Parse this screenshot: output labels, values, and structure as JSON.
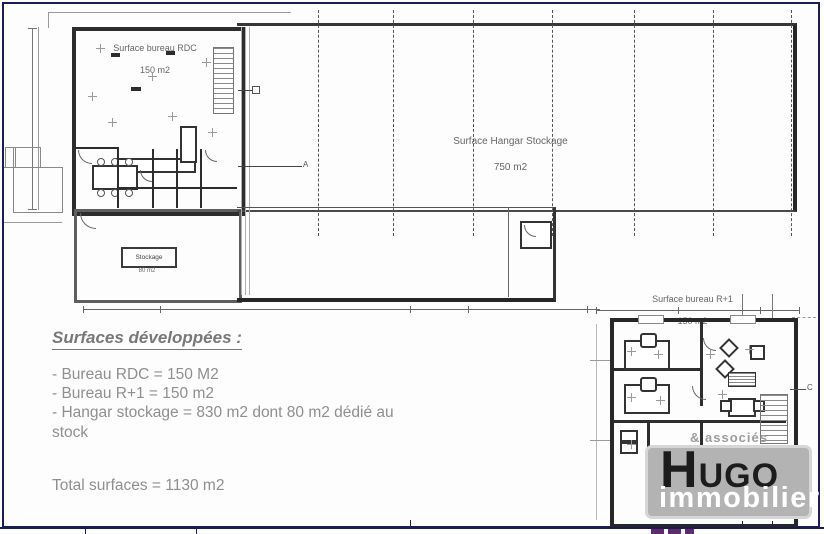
{
  "frame": {
    "border_color": "#1b1b55",
    "background": "#fdfdfd"
  },
  "plans": {
    "rdc": {
      "title": "Surface bureau RDC",
      "area": "150 m2"
    },
    "hangar": {
      "title": "Surface Hangar Stockage",
      "area": "750 m2"
    },
    "r1": {
      "title": "Surface bureau R+1",
      "area": "150 m2"
    },
    "stockage": {
      "title": "Stockage",
      "area": "80 m2"
    },
    "markers": {
      "a": "A",
      "c": "C"
    }
  },
  "summary": {
    "title": "Surfaces développées :",
    "items": [
      "- Bureau RDC = 150 M2",
      "- Bureau R+1 = 150 m2",
      "- Hangar stockage = 830 m2 dont 80 m2 dédié au stock"
    ],
    "total": "Total surfaces = 1130 m2"
  },
  "logo": {
    "brand_initial": "H",
    "brand_rest": "UGO",
    "brand_sub": "immobilier",
    "tagline": "& associés",
    "bg_color": "#b3b3b3",
    "dark_color": "#1c1c1c",
    "light_color": "#ffffff"
  }
}
